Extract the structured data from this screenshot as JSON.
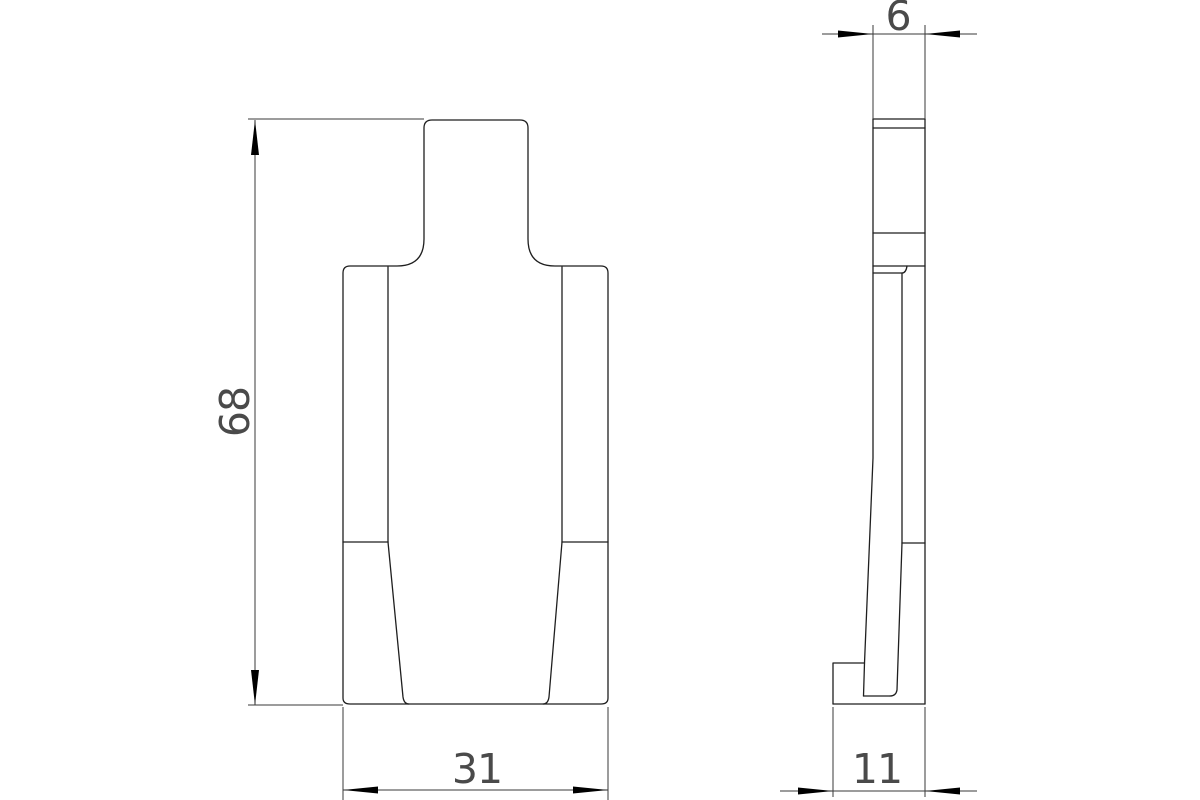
{
  "colors": {
    "background": "#ffffff",
    "line": "#1f1f1f",
    "dim_line": "#3a3a3a",
    "arrow": "#000000",
    "text": "#4a4a4a"
  },
  "views": {
    "front": {
      "dims": {
        "height": {
          "value": "68",
          "orientation": "vertical"
        },
        "width": {
          "value": "31",
          "orientation": "horizontal"
        }
      }
    },
    "side": {
      "dims": {
        "top_thickness": {
          "value": "6",
          "orientation": "horizontal"
        },
        "base_thickness": {
          "value": "11",
          "orientation": "horizontal"
        }
      }
    }
  }
}
